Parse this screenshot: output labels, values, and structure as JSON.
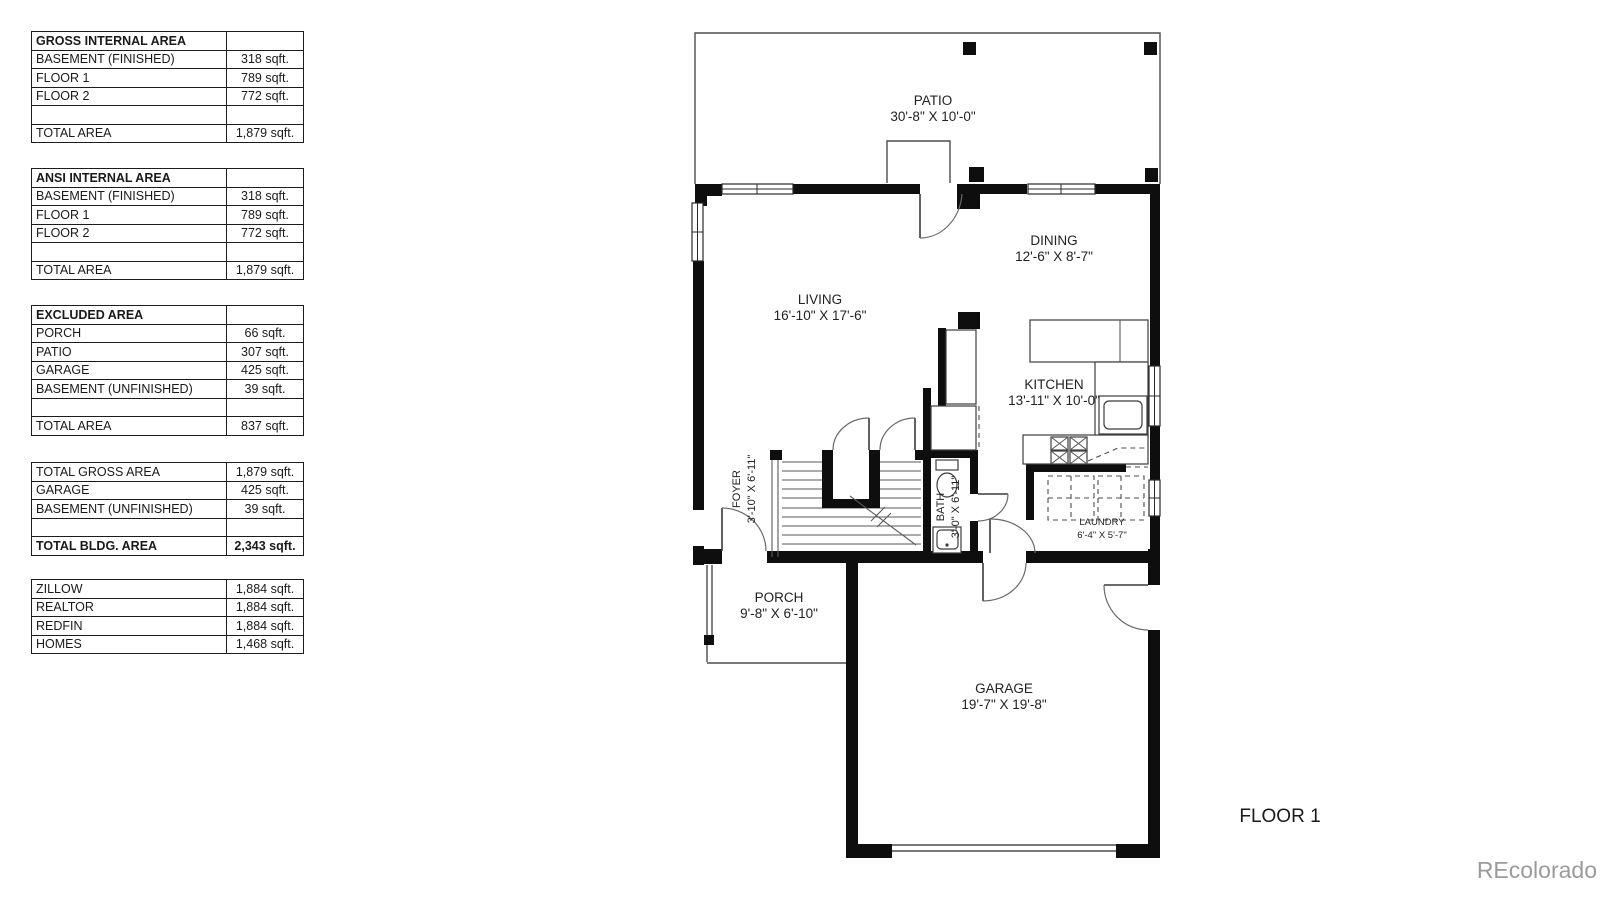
{
  "tables": [
    {
      "title": "GROSS INTERNAL AREA",
      "rows": [
        [
          "GROSS INTERNAL AREA",
          ""
        ],
        [
          "BASEMENT (FINISHED)",
          "318 sqft."
        ],
        [
          "FLOOR 1",
          "789 sqft."
        ],
        [
          "FLOOR 2",
          "772 sqft."
        ],
        [
          "",
          ""
        ],
        [
          "TOTAL AREA",
          "1,879 sqft."
        ]
      ]
    },
    {
      "title": "ANSI INTERNAL AREA",
      "rows": [
        [
          "ANSI INTERNAL AREA",
          ""
        ],
        [
          "BASEMENT (FINISHED)",
          "318 sqft."
        ],
        [
          "FLOOR 1",
          "789 sqft."
        ],
        [
          "FLOOR 2",
          "772 sqft."
        ],
        [
          "",
          ""
        ],
        [
          "TOTAL AREA",
          "1,879 sqft."
        ]
      ]
    },
    {
      "title": "EXCLUDED AREA",
      "rows": [
        [
          "EXCLUDED AREA",
          ""
        ],
        [
          "PORCH",
          "66 sqft."
        ],
        [
          "PATIO",
          "307 sqft."
        ],
        [
          "GARAGE",
          "425 sqft."
        ],
        [
          "BASEMENT (UNFINISHED)",
          "39 sqft."
        ],
        [
          "",
          ""
        ],
        [
          "TOTAL AREA",
          "837 sqft."
        ]
      ]
    },
    {
      "title": "TOTALS",
      "rows": [
        [
          "TOTAL GROSS AREA",
          "1,879 sqft."
        ],
        [
          "GARAGE",
          "425 sqft."
        ],
        [
          "BASEMENT (UNFINISHED)",
          "39 sqft."
        ],
        [
          "",
          ""
        ],
        [
          "TOTAL BLDG. AREA",
          "2,343 sqft."
        ]
      ]
    },
    {
      "title": "LISTING SOURCES",
      "rows": [
        [
          "ZILLOW",
          "1,884 sqft."
        ],
        [
          "REALTOR",
          "1,884 sqft."
        ],
        [
          "REDFIN",
          "1,884 sqft."
        ],
        [
          "HOMES",
          "1,468 sqft."
        ]
      ]
    }
  ],
  "floorplan": {
    "rooms": {
      "patio": {
        "name": "PATIO",
        "dims": "30'-8\" X 10'-0\""
      },
      "dining": {
        "name": "DINING",
        "dims": "12'-6\" X 8'-7\""
      },
      "living": {
        "name": "LIVING",
        "dims": "16'-10\" X 17'-6\""
      },
      "kitchen": {
        "name": "KITCHEN",
        "dims": "13'-11\" X 10'-0\""
      },
      "foyer": {
        "name": "FOYER",
        "dims": "3'-10\" X 6'-11\""
      },
      "bath": {
        "name": "BATH",
        "dims": "3'-0\" X 6'-11\""
      },
      "laundry": {
        "name": "LAUNDRY",
        "dims": "6'-4\" X 5'-7\""
      },
      "porch": {
        "name": "PORCH",
        "dims": "9'-8\" X 6'-10\""
      },
      "garage": {
        "name": "GARAGE",
        "dims": "19'-7\" X 19'-8\""
      }
    },
    "floor_label": "FLOOR 1",
    "watermark": "REcolorado"
  },
  "colors": {
    "wall": "#0e0e0e",
    "line": "#4d4d4d",
    "text": "#222222",
    "watermark": "#9b9b9b"
  }
}
